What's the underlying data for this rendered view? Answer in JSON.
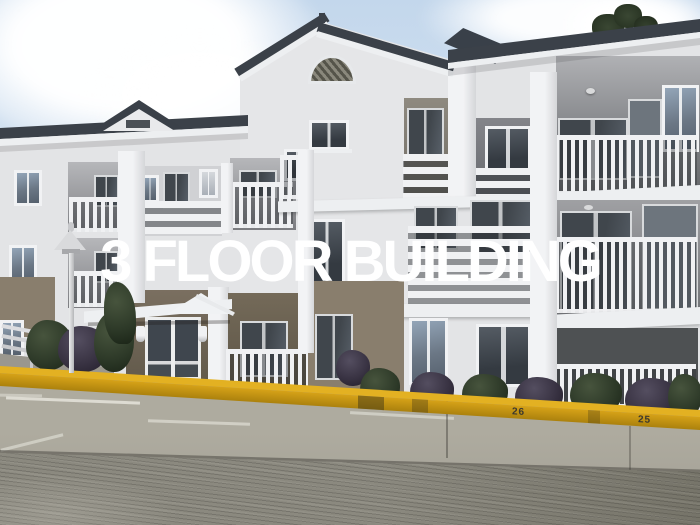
{
  "overlay": {
    "caption": "3 FLOOR BUILDING"
  },
  "curb": {
    "stall_number_center": "26",
    "stall_number_right": "25"
  },
  "scene": {
    "type": "photograph",
    "subject": "Three-storey apartment building with white balcony railings above a concrete parking lot",
    "elements": [
      "gabled roofs",
      "semicircular gable vent",
      "dormer",
      "balconies with vertical balusters",
      "balconies with horizontal slats",
      "entrance with white canopy and glass double doors",
      "wall lanterns",
      "street lamp post",
      "stair handrail",
      "shrubs",
      "yellow painted curb with stall numbers",
      "white parking stall lines",
      "brushed concrete pavement",
      "sky with clouds",
      "tree branch over roof"
    ]
  },
  "colors": {
    "sky": "#c7daec",
    "cloud": "#ffffff",
    "wall": "#e3e4e6",
    "wall_shade": "#c9cacd",
    "taupe": "#897e6d",
    "taupe_dark": "#675d4e",
    "roof": "#3b4149",
    "fascia": "#edeff1",
    "glass_dark": "#454c54",
    "glass_blue": "#8fa2b5",
    "railing": "#f0f1f3",
    "curb_yellow": "#d6a218",
    "pavement": "#a5a299",
    "pavement_dark": "#84827a",
    "foliage": "#2c3827",
    "text": "#ffffff"
  }
}
